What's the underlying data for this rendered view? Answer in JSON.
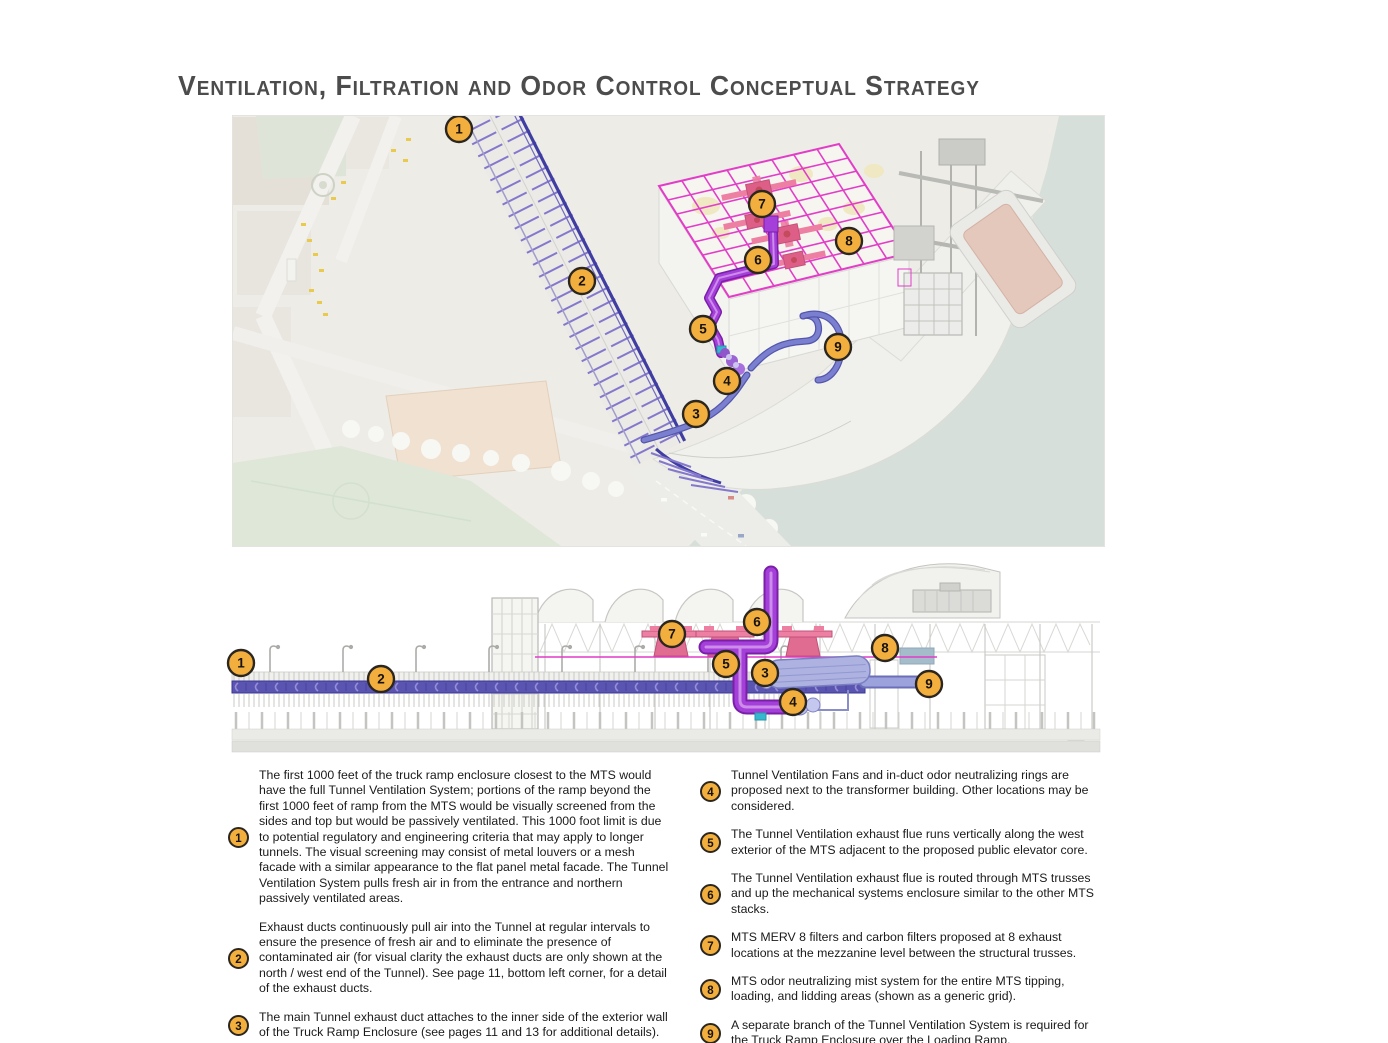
{
  "page": {
    "title": "Ventilation, Filtration and Odor Control Conceptual Strategy"
  },
  "colors": {
    "callout_fill": "#F2AF3D",
    "callout_border": "#2B2620",
    "duct_purple": "#A43FD9",
    "duct_purple_dark": "#7A1FA8",
    "duct_purple_light": "#CD8BEA",
    "duct_blue": "#7B7FD0",
    "duct_blue_dark": "#5356AC",
    "grid_magenta": "#E23CC8",
    "fan_pink": "#EC7FA2",
    "fan_pink_dark": "#C2517A",
    "ramp_indigo": "#403DA2",
    "band_indigo": "#5B55B2",
    "water": "#D7DFDA",
    "teal_accent": "#35B8CE"
  },
  "callouts": {
    "plan": [
      "1",
      "2",
      "3",
      "4",
      "5",
      "6",
      "7",
      "8",
      "9"
    ],
    "elevation": [
      "1",
      "2",
      "3",
      "4",
      "5",
      "6",
      "7",
      "8",
      "9"
    ]
  },
  "notes": {
    "left": [
      {
        "num": "1",
        "text": "The first 1000 feet of the truck ramp enclosure closest to the MTS would have the full Tunnel Ventilation System; portions of the ramp beyond the first 1000 feet of ramp from the MTS would be visually screened from the sides and top but would be passively ventilated. This 1000 foot limit is due to potential regulatory and engineering criteria that may apply to longer tunnels. The visual screening may consist of metal louvers or a mesh facade with a similar appearance to the flat panel metal facade. The Tunnel Ventilation System pulls fresh air in from the entrance and northern passively ventilated areas."
      },
      {
        "num": "2",
        "text": "Exhaust ducts continuously pull air into the Tunnel at regular intervals to ensure the presence of fresh air and to eliminate the presence of contaminated air (for visual clarity the exhaust ducts are only shown at the north / west end of the Tunnel). See page 11, bottom left corner, for a detail of the exhaust ducts."
      },
      {
        "num": "3",
        "text": "The main Tunnel exhaust duct attaches to the inner side of the exterior wall of the Truck Ramp Enclosure (see pages 11 and 13 for additional details)."
      }
    ],
    "right": [
      {
        "num": "4",
        "text": "Tunnel Ventilation Fans and in-duct odor neutralizing rings are proposed next to the transformer building. Other locations may be considered."
      },
      {
        "num": "5",
        "text": "The Tunnel Ventilation exhaust flue runs vertically along the west exterior of the MTS adjacent to the proposed public elevator core."
      },
      {
        "num": "6",
        "text": "The Tunnel Ventilation exhaust flue is routed through MTS trusses and up the mechanical systems enclosure similar to the other MTS stacks."
      },
      {
        "num": "7",
        "text": "MTS MERV 8 filters and carbon filters proposed at 8 exhaust locations at the mezzanine level between the structural trusses."
      },
      {
        "num": "8",
        "text": "MTS odor neutralizing mist system for the entire MTS tipping, loading, and lidding areas (shown as a generic grid)."
      },
      {
        "num": "9",
        "text": "A separate branch of the Tunnel Ventilation System is required for the Truck Ramp Enclosure over the Loading Ramp."
      }
    ]
  }
}
